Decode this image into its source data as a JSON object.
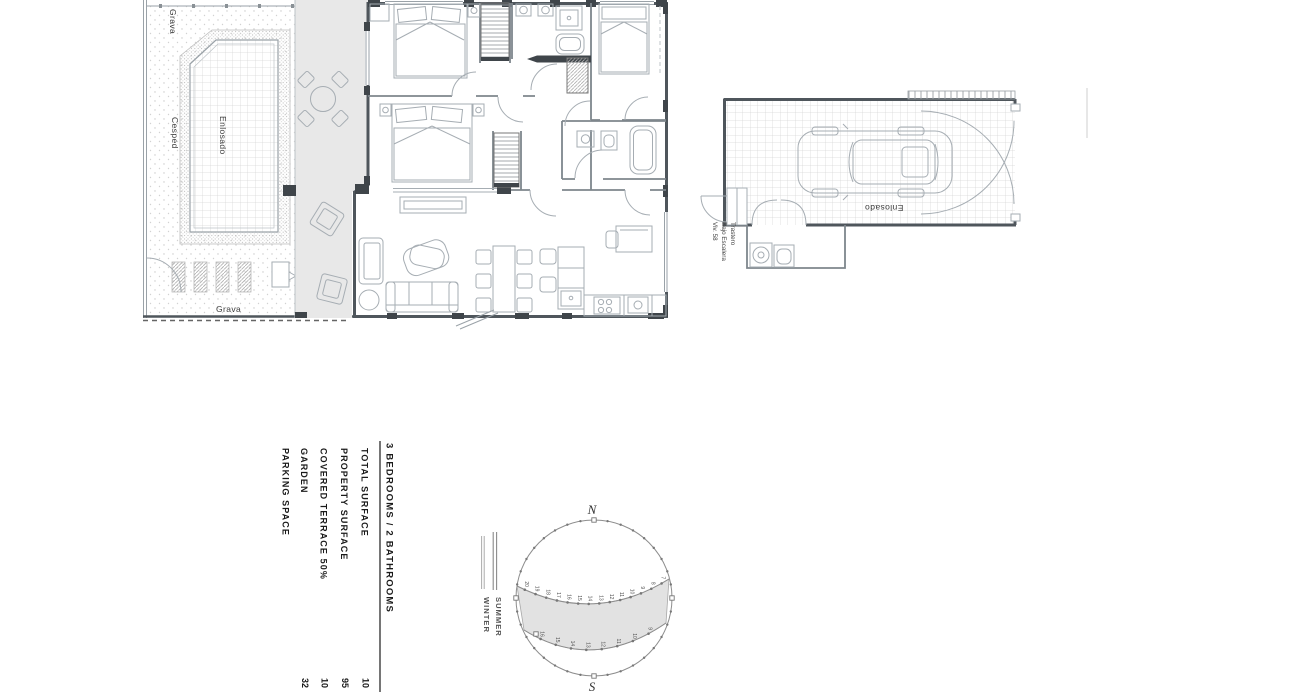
{
  "colors": {
    "background": "#ffffff",
    "wall": "#4f565c",
    "linework": "#a6adb3",
    "terrace_fill": "#e8e8e8",
    "sun_band_fill": "#e2e2e2",
    "text": "#1a1a1a"
  },
  "garden": {
    "grava_top": "Grava",
    "cesped": "Cesped",
    "enlosado": "Enlosado",
    "grava_bottom": "Grava"
  },
  "garage": {
    "enlosado": "Enlosado",
    "storage_line1": "Trastero",
    "storage_line2": "Bajo Escalera",
    "storage_line3": "Viv. 58"
  },
  "summary": {
    "title": "3 BEDROOMS / 2 BATHROOMS",
    "rows": [
      {
        "label": "TOTAL SURFACE",
        "value": "10"
      },
      {
        "label": "PROPERTY SURFACE",
        "value": "95"
      },
      {
        "label": "COVERED TERRACE 50%",
        "value": "10"
      },
      {
        "label": "GARDEN",
        "value": "32"
      },
      {
        "label": "PARKING SPACE",
        "value": ""
      }
    ]
  },
  "sun_diagram": {
    "north_label": "N",
    "south_label": "S",
    "legend_summer": "SUMMER",
    "legend_winter": "WINTER",
    "summer_hours": [
      "20",
      "19",
      "18",
      "17",
      "16",
      "15",
      "14",
      "13",
      "12",
      "11",
      "10",
      "9",
      "8",
      "7"
    ],
    "winter_hours": [
      "16",
      "15",
      "14",
      "13",
      "12",
      "11",
      "10",
      "9"
    ]
  }
}
